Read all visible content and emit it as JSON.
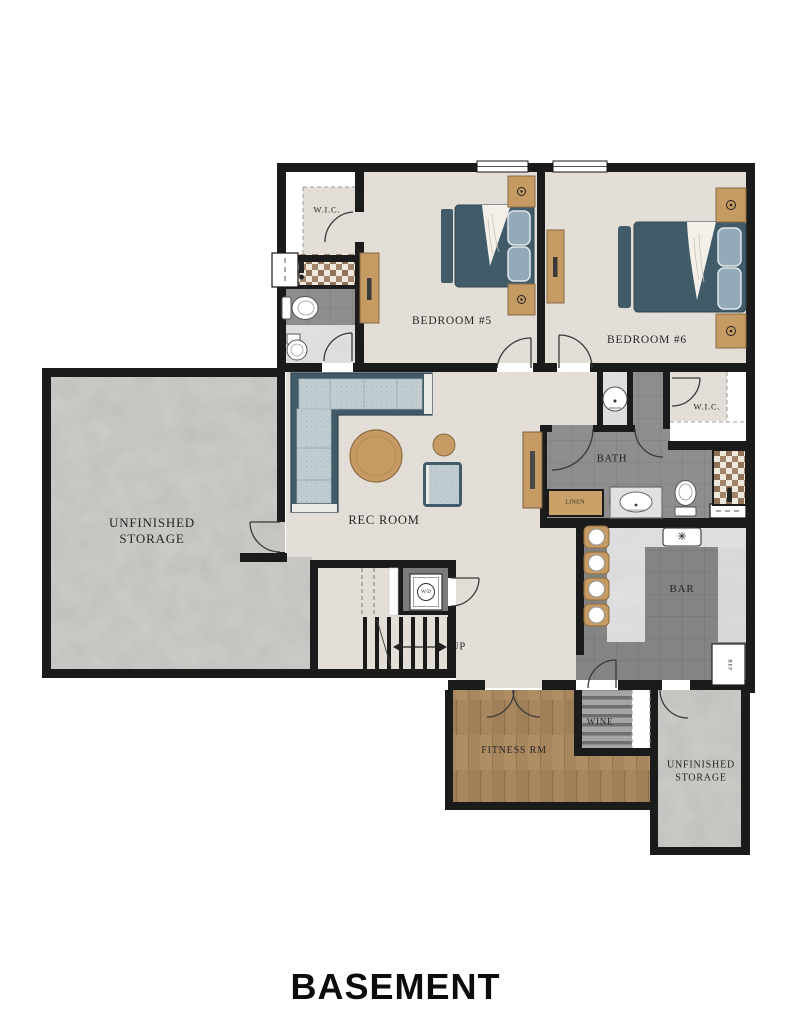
{
  "title": "BASEMENT",
  "rooms": {
    "wic_upper": "W.I.C.",
    "bedroom5": "BEDROOM #5",
    "bedroom6": "BEDROOM #6",
    "wic_right": "W.I.C.",
    "bath": "BATH",
    "linen": "LINEN",
    "rec_room": "REC ROOM",
    "storage_left": "UNFINISHED STORAGE",
    "bar": "BAR",
    "stairs_up": "UP",
    "washer_dryer": "W/D",
    "refrigerator": "REF",
    "wine": "WINE",
    "fitness": "FITNESS RM",
    "storage_lower": "UNFINISHED STORAGE"
  },
  "colors": {
    "wall": "#1b1b1b",
    "floor_fabric": "#e3dfd8",
    "concrete": "#cfcdca",
    "tile": "#8e8e8e",
    "wood_floor": "#a8875f",
    "furniture_wood": "#c59b63",
    "bed": "#415c68",
    "cushion": "#c2cdd2",
    "marble": "#e2e2e2",
    "checker": "#a3846a"
  }
}
